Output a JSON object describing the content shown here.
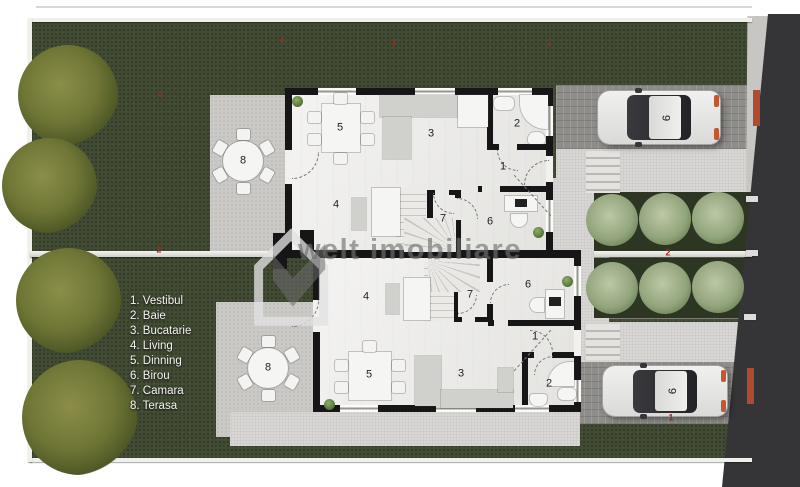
{
  "watermark": {
    "brand": "welt imobiliare"
  },
  "legend": {
    "items": [
      "1. Vestibul",
      "2. Baie",
      "3. Bucatarie",
      "4. Living",
      "5. Dinning",
      "6. Birou",
      "7. Camara",
      "8. Terasa"
    ]
  },
  "room_numbers": {
    "vestibul": "1",
    "baie": "2",
    "bucatarie": "3",
    "living": "4",
    "dinning": "5",
    "birou": "6",
    "camara": "7",
    "terasa": "8"
  },
  "car_label": "9",
  "site_marks": {
    "top_a": "4",
    "top_b": "3",
    "top_c": "1",
    "left_lawn": "4",
    "divider_left": "2",
    "divider_right": "2",
    "drive_bottom": "1"
  },
  "colors": {
    "grass": "#414a33",
    "wall": "#161616",
    "accent_red": "#93301f",
    "watermark_gray": "#484848",
    "car_tail": "#c4572f",
    "bush": "#94a67e",
    "tree": "#6f7635"
  }
}
